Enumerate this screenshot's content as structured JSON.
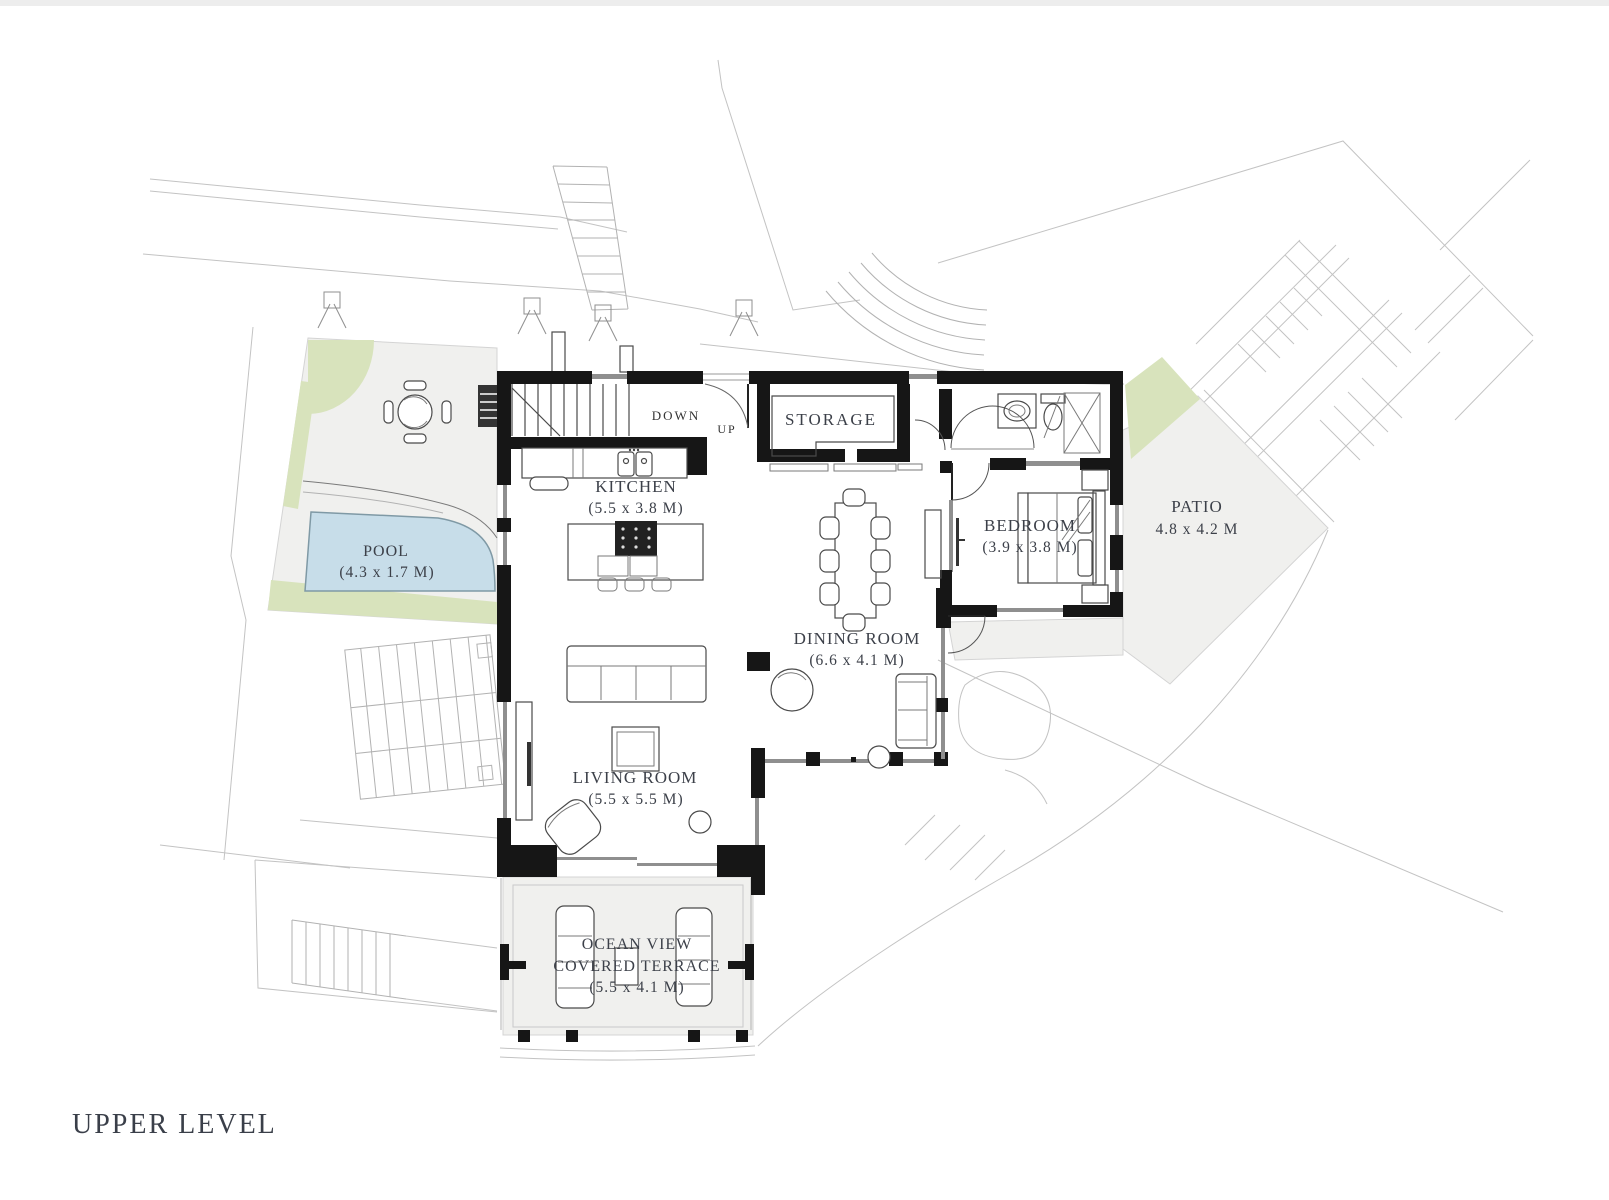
{
  "page": {
    "title_label": "UPPER LEVEL"
  },
  "colors": {
    "wall": "#161616",
    "pool_fill": "#c7dde9",
    "pool_edge": "#7f99a5",
    "landscape_green": "#d8e3bc",
    "hardscape_gray": "#f0f0ee",
    "site_line": "#c3c3c3",
    "label_text": "#3c4049"
  },
  "plan": {
    "level_title": "UPPER LEVEL",
    "stairs": {
      "down": "DOWN",
      "up": "UP"
    },
    "rooms": {
      "kitchen": {
        "name": "KITCHEN",
        "dims": "(5.5 x 3.8 M)"
      },
      "storage": {
        "name": "STORAGE",
        "dims": ""
      },
      "dining": {
        "name": "DINING ROOM",
        "dims": "(6.6 x 4.1 M)"
      },
      "living": {
        "name": "LIVING ROOM",
        "dims": "(5.5 x 5.5 M)"
      },
      "bedroom": {
        "name": "BEDROOM",
        "dims": "(3.9 x 3.8 M)"
      },
      "patio": {
        "name": "PATIO",
        "dims": "4.8 x 4.2 M"
      },
      "pool": {
        "name": "POOL",
        "dims": "(4.3 x 1.7 M)"
      },
      "terrace": {
        "line1": "OCEAN VIEW",
        "line2": "COVERED TERRACE",
        "dims": "(5.5 x 4.1 M)"
      }
    }
  }
}
